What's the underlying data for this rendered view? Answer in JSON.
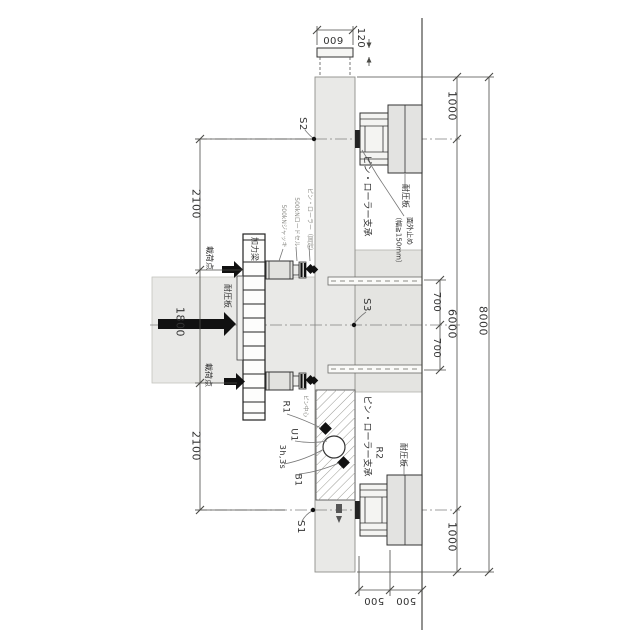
{
  "drawing": {
    "dimensions": {
      "plate_width": "600",
      "plate_thickness": "120",
      "left": [
        "2100",
        "1800",
        "2100"
      ],
      "stub": [
        "700",
        "700"
      ],
      "overhang_top": "1000",
      "span": "6000",
      "overhang_bottom": "1000",
      "total": "8000",
      "bottom": [
        "500",
        "500"
      ]
    },
    "labels": {
      "s2": "S2",
      "s3": "S3",
      "s1": "S1",
      "load_point_upper": "載荷点",
      "load_point_lower": "載荷点",
      "loading_beam": "加力梁",
      "bearing_plate_loading": "耐圧板",
      "jack": "500kNジャッキ",
      "load_cell": "500kNロードセル",
      "pin_roller_fixed": "ピン・ローラー（固定）",
      "pin_roller_bearing_top": "ピン・ローラー支承",
      "bearing_plate_top": "耐圧板",
      "out_of_plane_restraint": "面外止め",
      "out_of_plane_width": "（幅≧150mm）",
      "pin_roller_bearing_bottom": "ピン・ローラー支承",
      "bearing_plate_bottom": "耐圧板",
      "r1": "R1",
      "pin_center": "ピン中心",
      "u1": "U1",
      "gauges": "3h,3s",
      "b1": "B1",
      "r2": "R2"
    },
    "colors": {
      "concrete": "#e9e9e7",
      "steel": "#f2f2f0",
      "hatch": "#9a9a94",
      "line": "#3a3a3a",
      "centerline": "#808080",
      "text": "#333333",
      "muted_text": "#8d8d88"
    }
  }
}
